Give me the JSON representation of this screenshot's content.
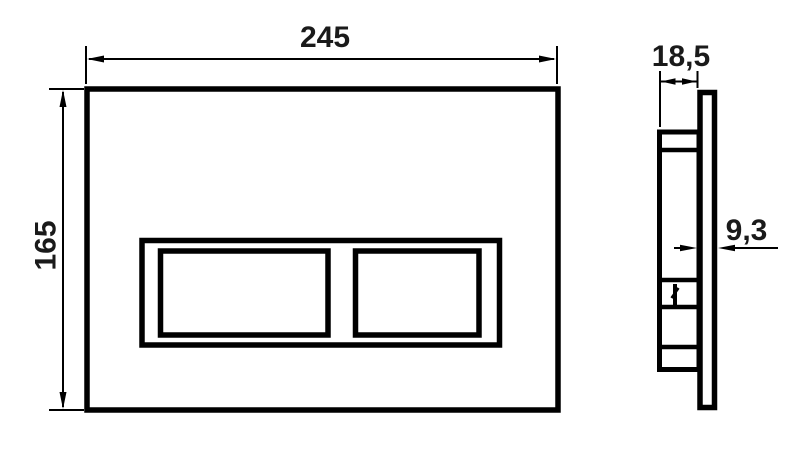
{
  "drawing": {
    "type": "technical-dimension-drawing",
    "subject": "toilet-flush-plate",
    "dimensions": {
      "width_label": "245",
      "height_label": "165",
      "depth_label": "18,5",
      "thickness_label": "9,3"
    },
    "colors": {
      "line": "#000000",
      "text": "#1a1a1a",
      "background": "#ffffff"
    }
  }
}
